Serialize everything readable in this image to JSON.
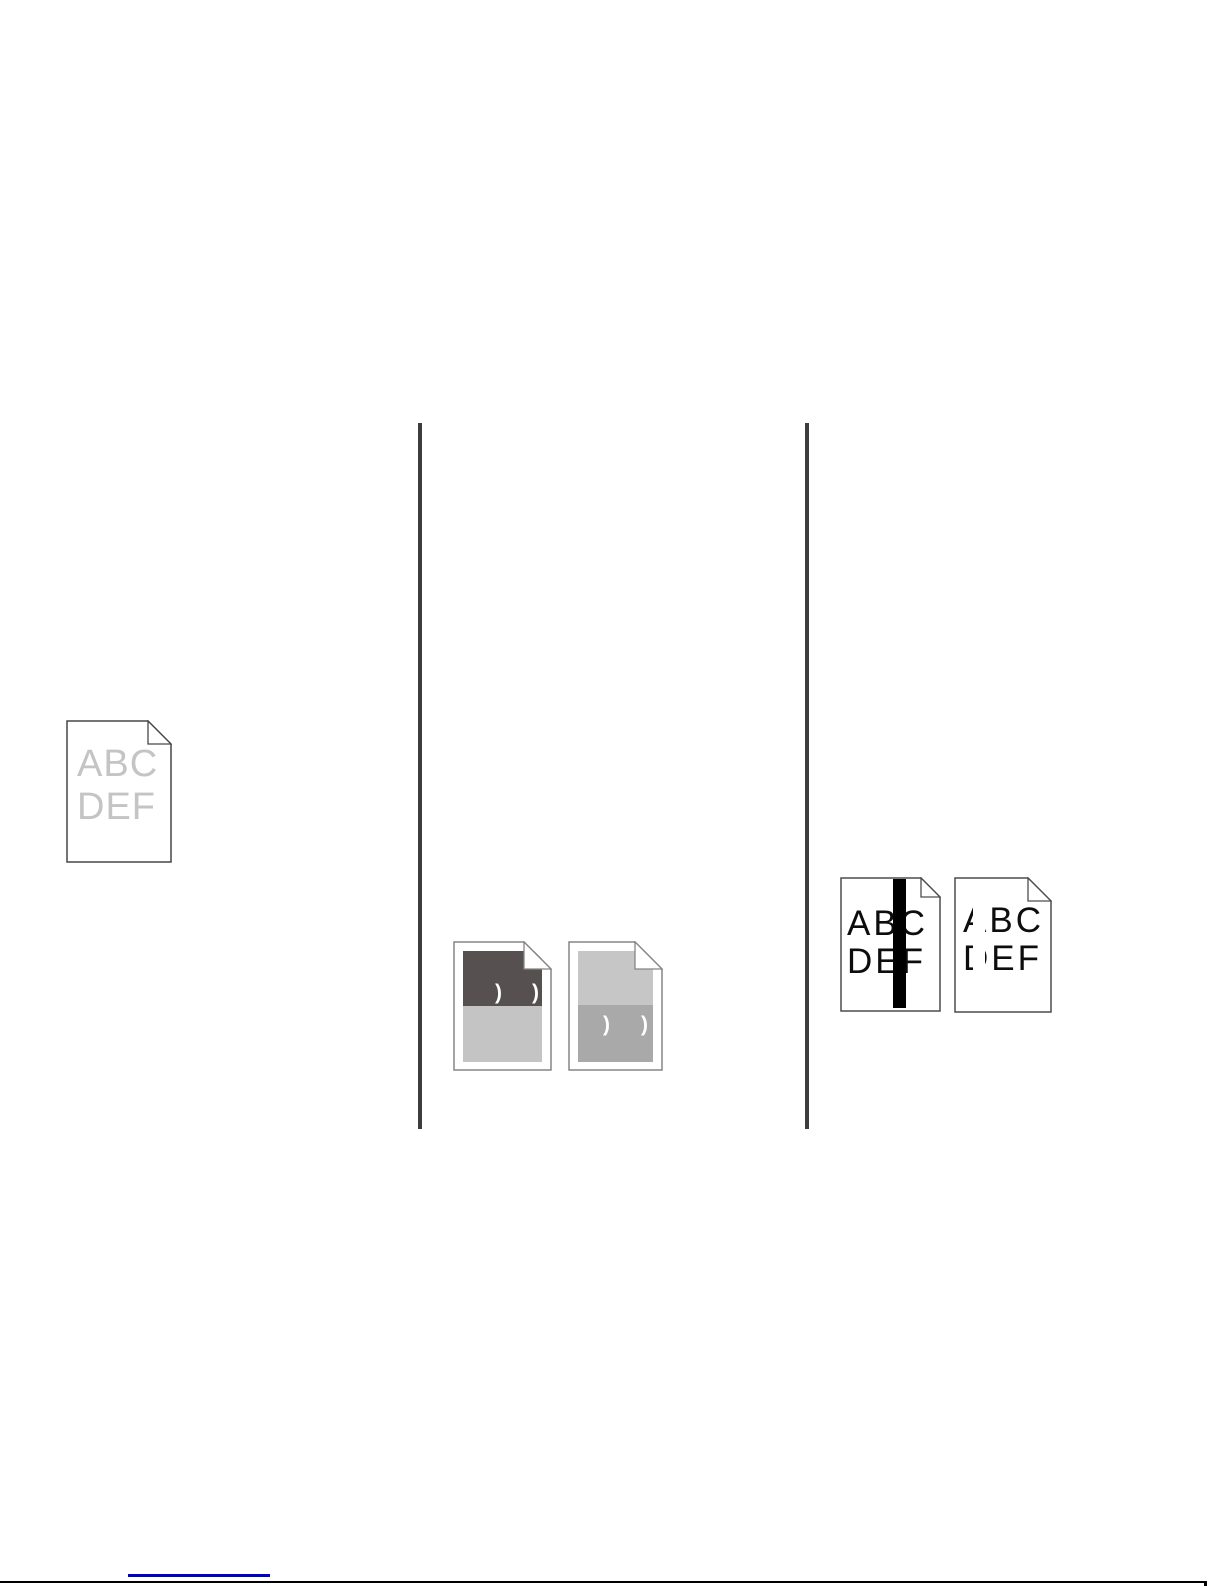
{
  "samples": {
    "faded": {
      "line1": "ABC",
      "line2": "DEF",
      "text_color": "#c4c4c4"
    },
    "dark_band": {
      "marks": [
        ")",
        ")"
      ],
      "upper_band_color": "#575050",
      "lower_band_color": "#c4c4c4",
      "mark_color": "#ffffff"
    },
    "gray_band": {
      "marks": [
        ")",
        ")"
      ],
      "upper_band_color": "#c6c6c6",
      "lower_band_color": "#a9a9a9",
      "mark_color": "#ffffff"
    },
    "black_streak": {
      "line1": "ABC",
      "line2": "DEF",
      "text_color": "#0d0d0d",
      "streak_color": "#000000"
    },
    "white_streak": {
      "line1": "ABC",
      "line2": "DEF",
      "text_color": "#0d0d0d",
      "streak_color": "#ffffff"
    }
  },
  "table": {
    "divider_color": "#3d3d3d"
  },
  "footer": {
    "link_underline_color": "#0000c8",
    "rule_color": "#000000"
  },
  "page_background": "#ffffff"
}
